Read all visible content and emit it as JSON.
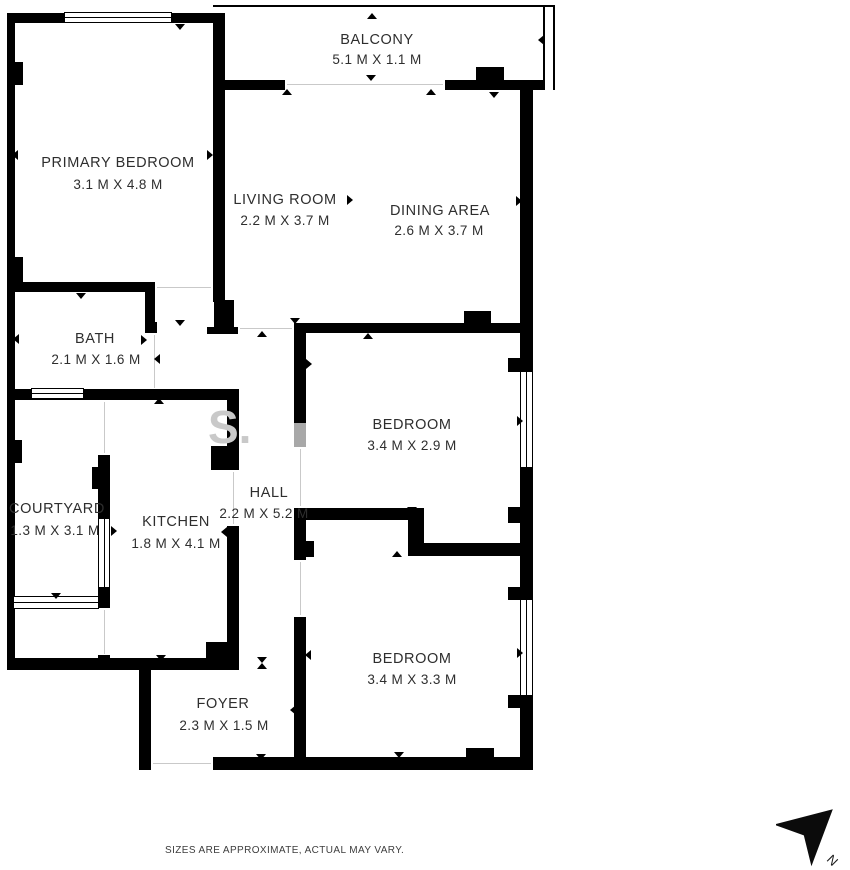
{
  "plan": {
    "rooms": [
      {
        "name": "PRIMARY BEDROOM",
        "dims": "3.1 M X 4.8 M"
      },
      {
        "name": "BALCONY",
        "dims": "5.1 M X 1.1 M"
      },
      {
        "name": "LIVING ROOM",
        "dims": "2.2 M X 3.7 M"
      },
      {
        "name": "DINING AREA",
        "dims": "2.6 M X 3.7 M"
      },
      {
        "name": "BATH",
        "dims": "2.1 M X 1.6 M"
      },
      {
        "name": "BEDROOM",
        "dims": "3.4 M X 2.9 M"
      },
      {
        "name": "COURTYARD",
        "dims": "1.3 M X 3.1 M"
      },
      {
        "name": "KITCHEN",
        "dims": "1.8 M X 4.1 M"
      },
      {
        "name": "HALL",
        "dims": "2.2 M X 5.2 M"
      },
      {
        "name": "BEDROOM",
        "dims": "3.4 M X 3.3 M"
      },
      {
        "name": "FOYER",
        "dims": "2.3 M X 1.5 M"
      }
    ],
    "disclaimer": "SIZES ARE APPROXIMATE, ACTUAL MAY VARY.",
    "compass_label": "N",
    "watermark": "S.",
    "wall_color": "#000000",
    "text_color": "#2e2e2e"
  }
}
